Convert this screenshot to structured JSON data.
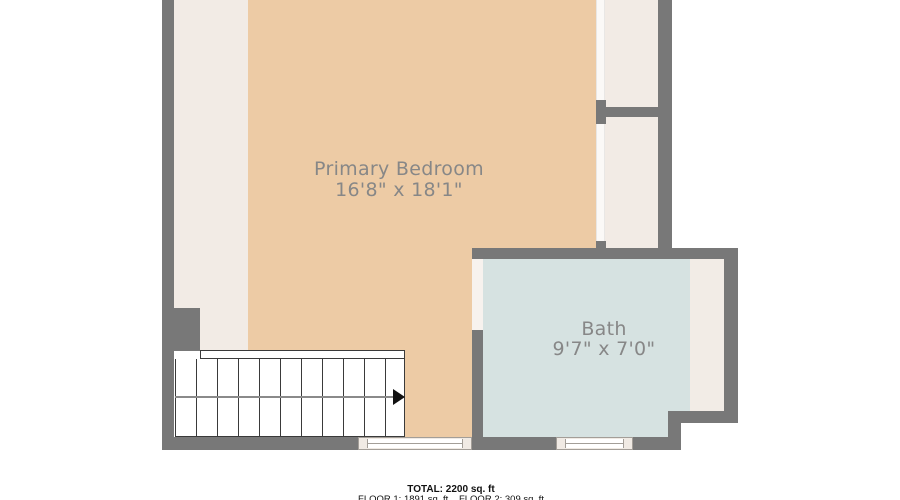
{
  "floorplan": {
    "rooms": [
      {
        "name": "Primary Bedroom",
        "dimensions": "16'8\" x 18'1\""
      },
      {
        "name": "Bath",
        "dimensions": "9'7\" x 7'0\""
      }
    ],
    "stairs": {
      "direction_arrow": "right"
    },
    "footer": {
      "total": "TOTAL: 2200 sq. ft",
      "floor1": "FLOOR 1: 1891 sq. ft",
      "floor2": "FLOOR 2: 309 sq. ft"
    },
    "colors": {
      "wall": "#787878",
      "bedroom_floor": "#edcba5",
      "closet_floor": "#f2ebe5",
      "bath_floor": "#d6e2e1",
      "bath_counter": "#f2ece6",
      "door_gap": "#f7f2ee",
      "slider": "#fbf9f7",
      "window_fill": "#f0eae4",
      "window_line": "#a39e98",
      "stair_line": "#3a3a3a",
      "stair_mid_line": "#8a8a8a",
      "room_label": "#878787",
      "footer_text": "#111111"
    }
  }
}
